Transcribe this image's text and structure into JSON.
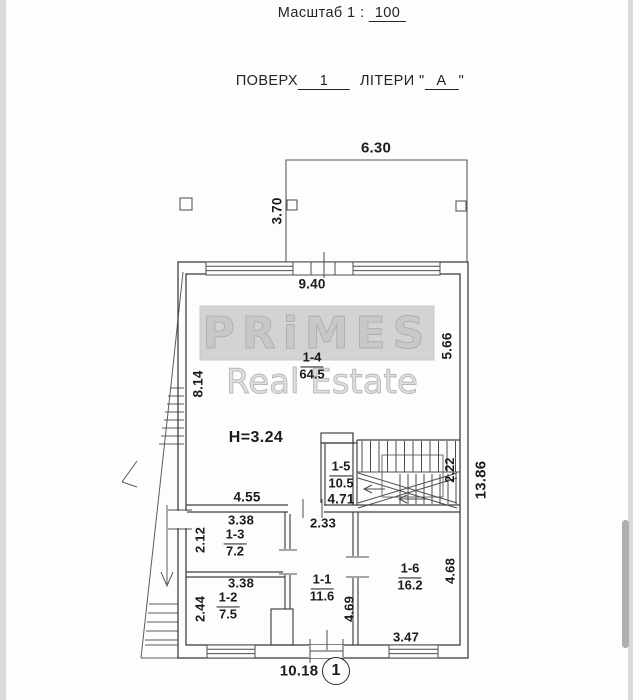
{
  "captions": {
    "scale_prefix": "Масштаб  1 :",
    "scale_value": "100",
    "floor_label": "ПОВЕРХ",
    "floor_value": "1",
    "letters_label": "ЛІТЕРИ",
    "quote_open": "\"",
    "letters_value": "А",
    "quote_close": "\""
  },
  "watermark": {
    "brand": "PRiMES",
    "tagline": "Real Estate"
  },
  "marker": {
    "number": "1"
  },
  "labels": {
    "height": "H=3.24",
    "dim_terrace_width": "6.30",
    "dim_terrace_depth": "3.70",
    "dim_room14_width": "9.40",
    "dim_room14_left": "8.14",
    "dim_room14_right": "5.66",
    "dim_room14_bottom": "4.55",
    "dim_stair_width": "2.22",
    "dim_total_height": "13.86",
    "dim_hall_bottom": "4.71",
    "dim_room13_top": "3.38",
    "dim_room13_left": "2.12",
    "dim_room11_top": "2.33",
    "dim_room12_top": "3.38",
    "dim_room12_left": "2.44",
    "dim_room11_right": "4.69",
    "dim_room16_right": "4.68",
    "dim_room16_bottom": "3.47",
    "dim_total_width": "10.18"
  },
  "rooms": [
    {
      "id": "1-1",
      "area": "11.6"
    },
    {
      "id": "1-2",
      "area": "7.5"
    },
    {
      "id": "1-3",
      "area": "7.2"
    },
    {
      "id": "1-4",
      "area": "64.5"
    },
    {
      "id": "1-5",
      "area": "10.5"
    },
    {
      "id": "1-6",
      "area": "16.2"
    }
  ]
}
